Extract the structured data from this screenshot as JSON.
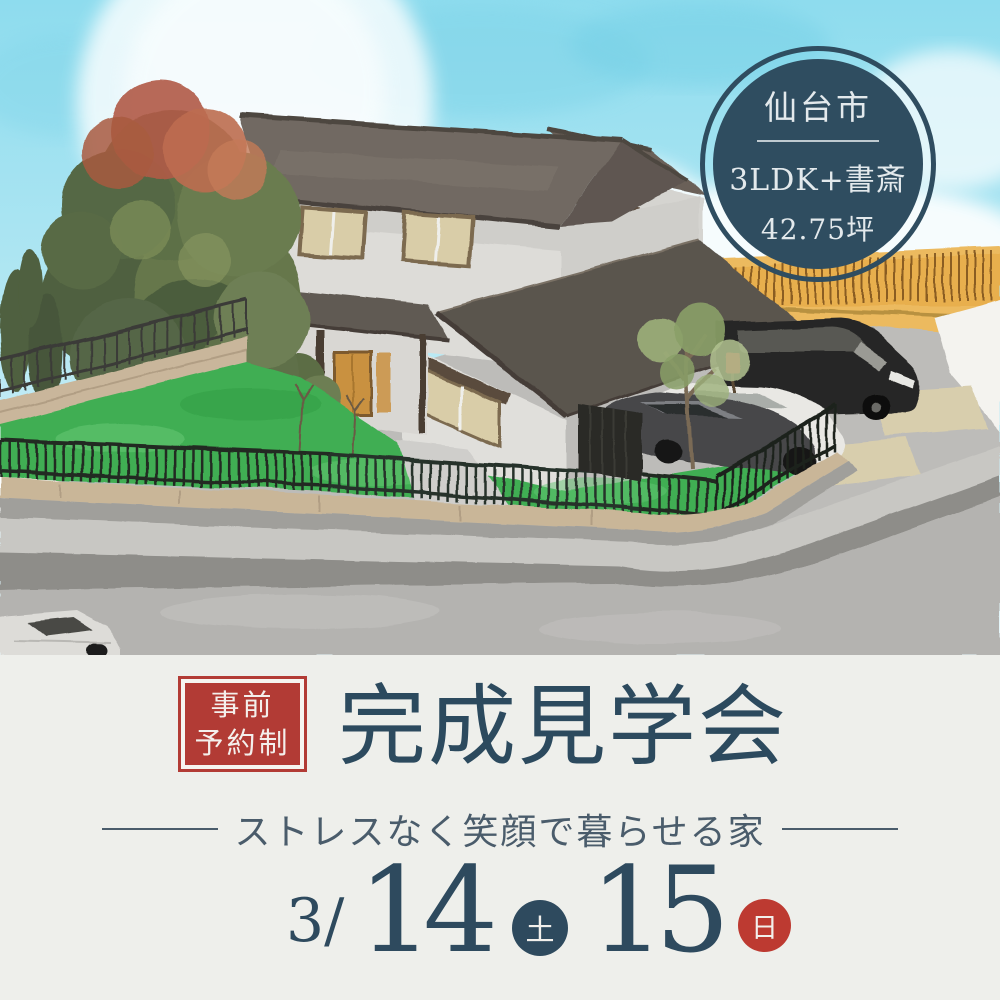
{
  "info_badge": {
    "city": "仙台市",
    "plan": "3LDK+書斎",
    "area": "42.75坪"
  },
  "reservation_badge": {
    "line1": "事前",
    "line2": "予約制"
  },
  "title": "完成見学会",
  "tagline": "ストレスなく笑顔で暮らせる家",
  "schedule": {
    "month": "3/",
    "day1": "14",
    "day1_dow": "土",
    "day2": "15",
    "day2_dow": "日"
  },
  "colors": {
    "navy": "#2e4a5e",
    "badge_navy": "#2f4d60",
    "badge_red": "#b23b35",
    "sunday_red": "#bd3a31",
    "panel_bg": "#eeefeb",
    "sky_blue": "#9fe2f0",
    "lawn_green": "#3fae52",
    "roof_gray": "#6e6660",
    "wall_gray": "#dddcd8",
    "fence_black": "#242a22",
    "orange_wall": "#ecba5e"
  },
  "scene_elements": [
    "sky",
    "sun",
    "clouds",
    "large-tree",
    "two-story-house",
    "entrance-porch",
    "garden-lawn",
    "metal-fence",
    "stone-wall",
    "driveway",
    "parked-cars",
    "orange-fence-wall"
  ]
}
